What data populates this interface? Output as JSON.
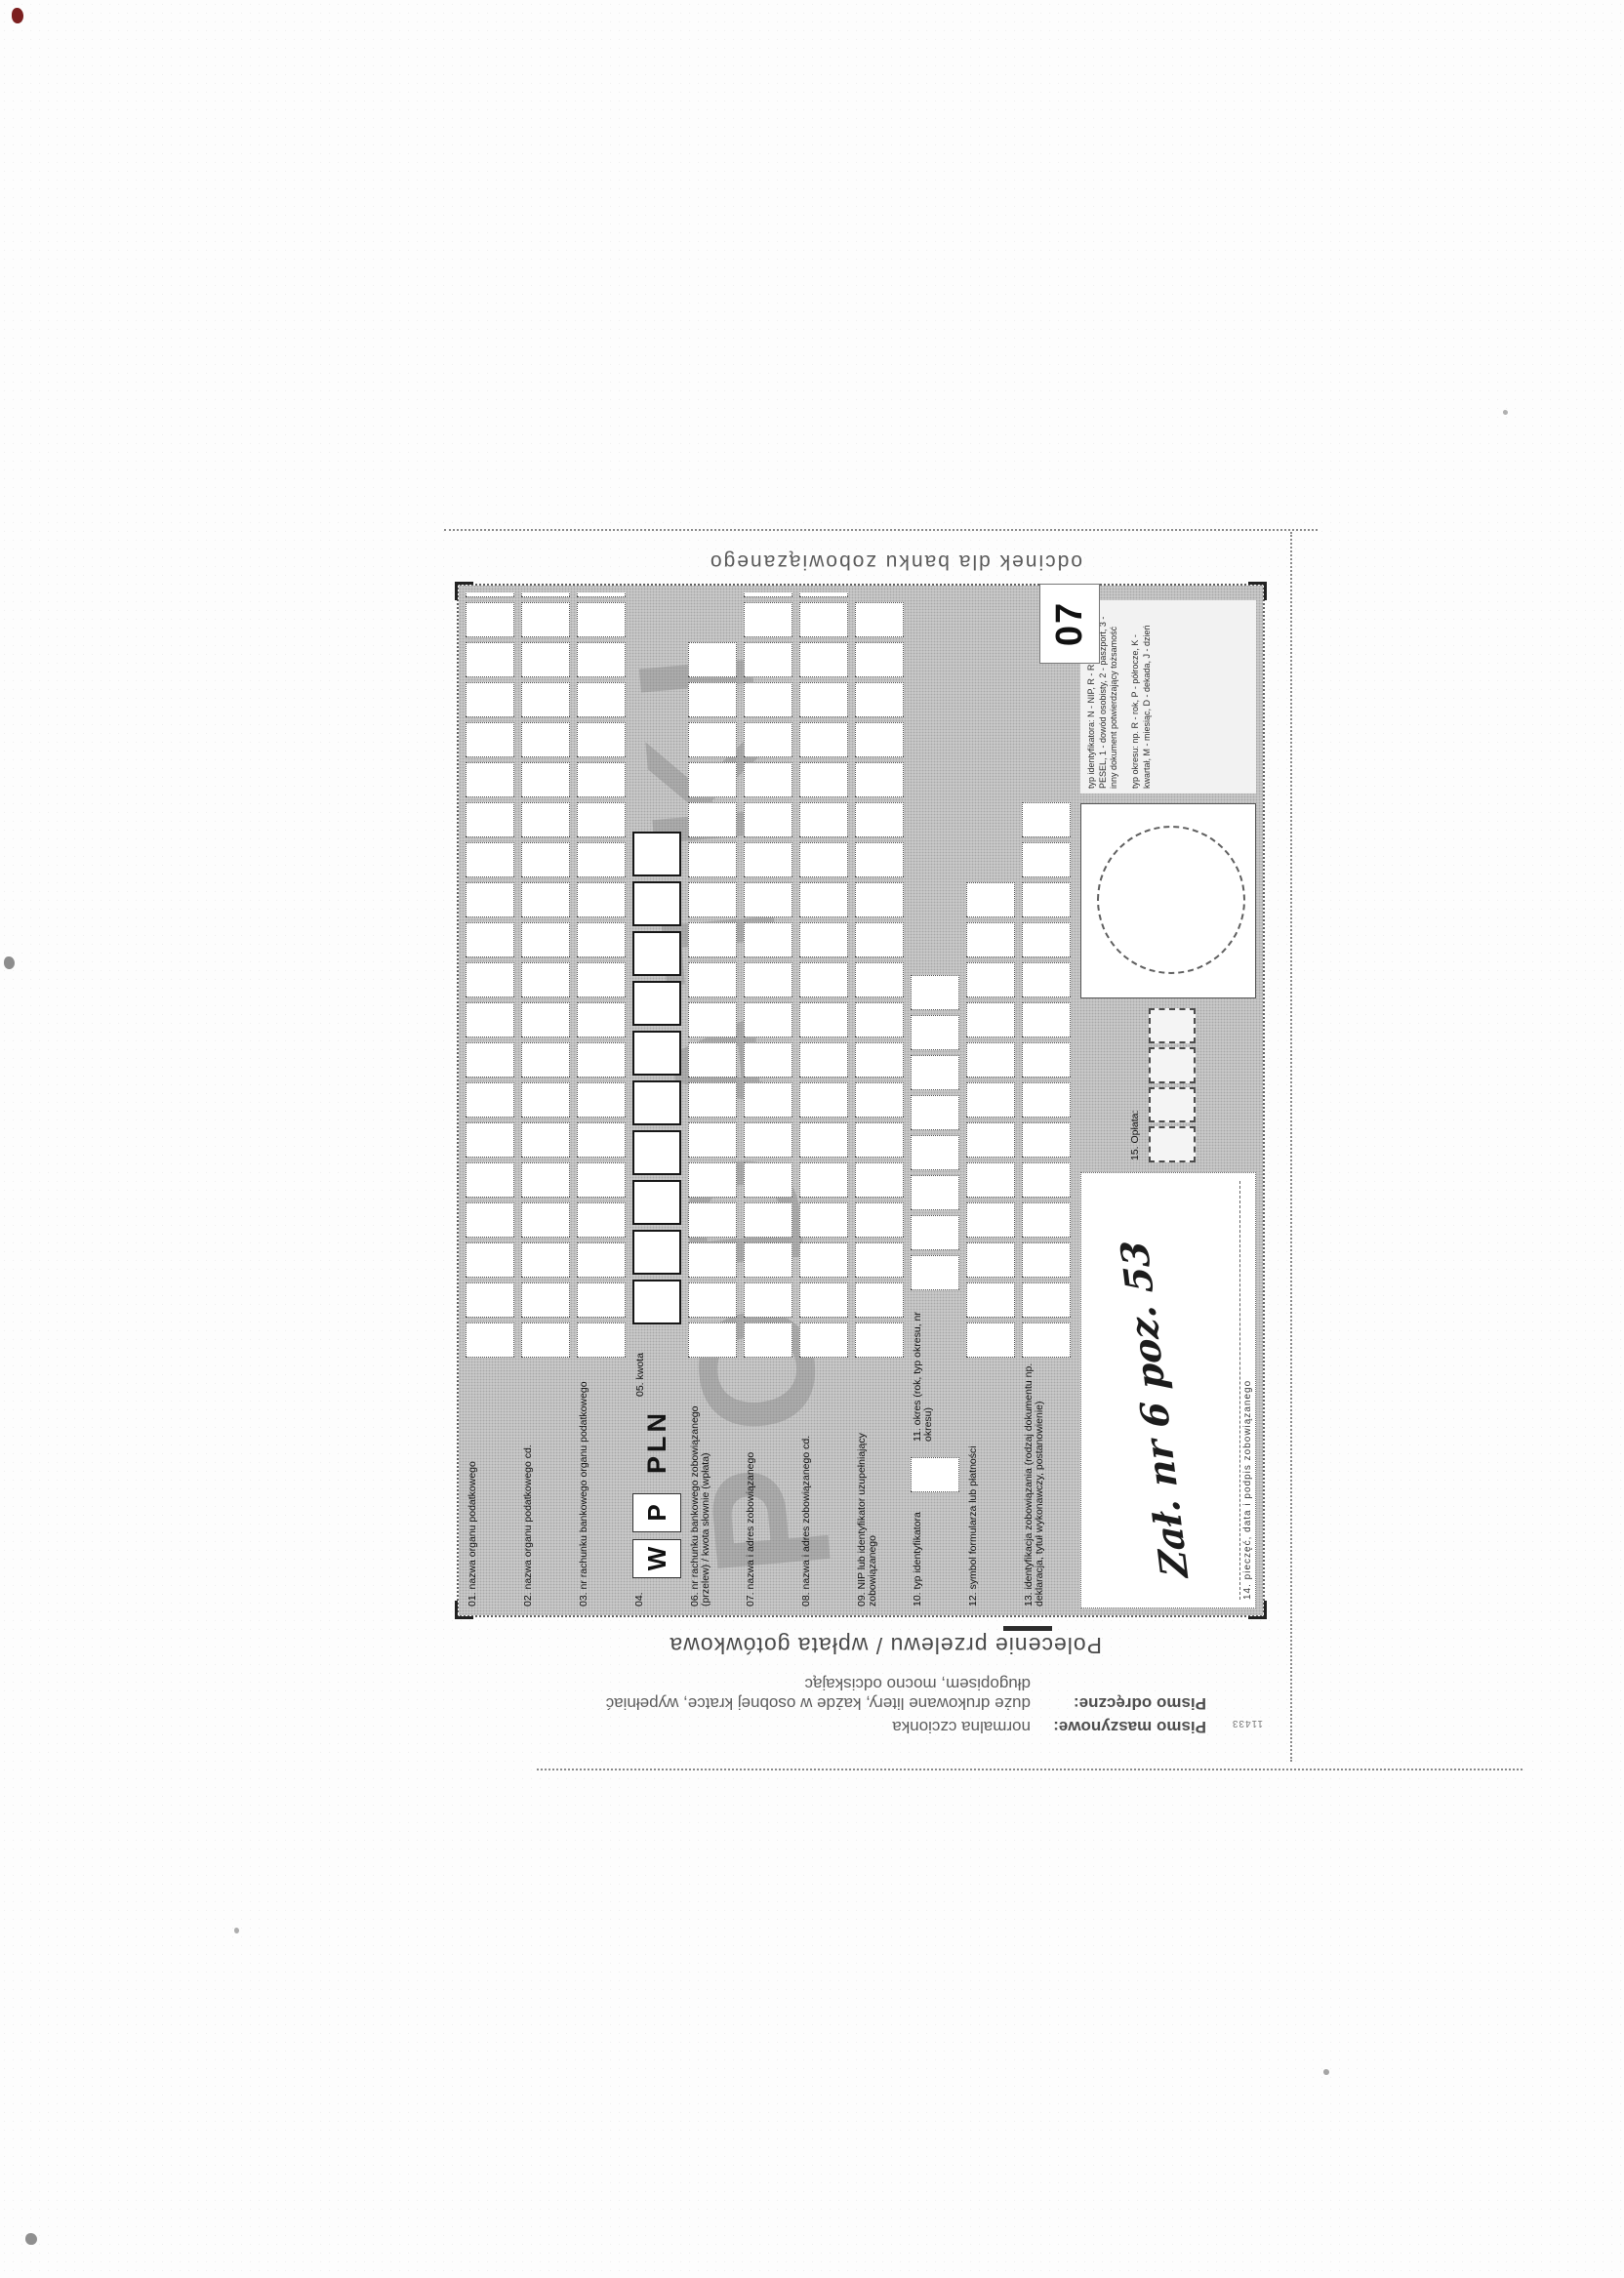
{
  "form": {
    "corner_number": "07",
    "watermark": "PODATKI",
    "side_captions": {
      "left_title": "Polecenie przelewu / wpłata gotówkowa",
      "right": "odcinek dla banku zobowiązanego"
    },
    "print_code": "11433",
    "instructions": [
      {
        "label": "Pismo maszynowe:",
        "text": "normalna czcionka"
      },
      {
        "label": "Pismo odręczne:",
        "text": "duże drukowane litery, każde w osobnej kratce, wypełniać długopisem, mocno odciskając"
      }
    ],
    "rows": [
      {
        "num": "01",
        "label": "01. nazwa organu podatkowego",
        "boxes": 20
      },
      {
        "num": "02",
        "label": "02. nazwa organu podatkowego cd.",
        "boxes": 20
      },
      {
        "num": "03",
        "label": "03. nr rachunku bankowego organu podatkowego",
        "boxes": 20
      },
      {
        "num": "06",
        "label": "06. nr rachunku bankowego zobowiązanego (przelew) / kwota słownie (wpłata)",
        "boxes": 18
      },
      {
        "num": "07",
        "label": "07. nazwa i adres zobowiązanego",
        "boxes": 20
      },
      {
        "num": "08",
        "label": "08. nazwa i adres zobowiązanego cd.",
        "boxes": 20
      },
      {
        "num": "09",
        "label": "09. NIP lub identyfikator uzupełniający zobowiązanego",
        "boxes": 19
      },
      {
        "num": "12",
        "label": "12. symbol formularza lub płatności",
        "boxes": 12
      },
      {
        "num": "13",
        "label": "13. identyfikacja zobowiązania (rodzaj dokumentu np. deklaracja, tytuł wykonawczy, postanowienie)",
        "boxes": 14
      }
    ],
    "row04": {
      "num": "04.",
      "w": "W",
      "p": "P",
      "currency": "PLN",
      "kwota_label": "05. kwota",
      "kwota_boxes": 10
    },
    "row10_11": {
      "f10": "10. typ identyfikatora",
      "f10_boxes": 1,
      "f11": "11. okres (rok, typ okresu, nr okresu)",
      "f11_boxes": 8
    },
    "bottom": {
      "f14_caption": "14. pieczęć, data i podpis zobowiązanego",
      "handwriting": "Zał. nr 6 poz. 53",
      "f15_label": "15. Opłata:",
      "f15_boxes": 4,
      "legend_id": "typ identyfikatora: N - NIP, R - REGON, P - PESEL, 1 - dowód osobisty, 2 - paszport, 3 - inny dokument potwierdzający tożsamość",
      "legend_okres": "typ okresu: np. R - rok, P - półrocze, K - kwartał, M - miesiąc, D - dekada, J - dzień"
    }
  }
}
